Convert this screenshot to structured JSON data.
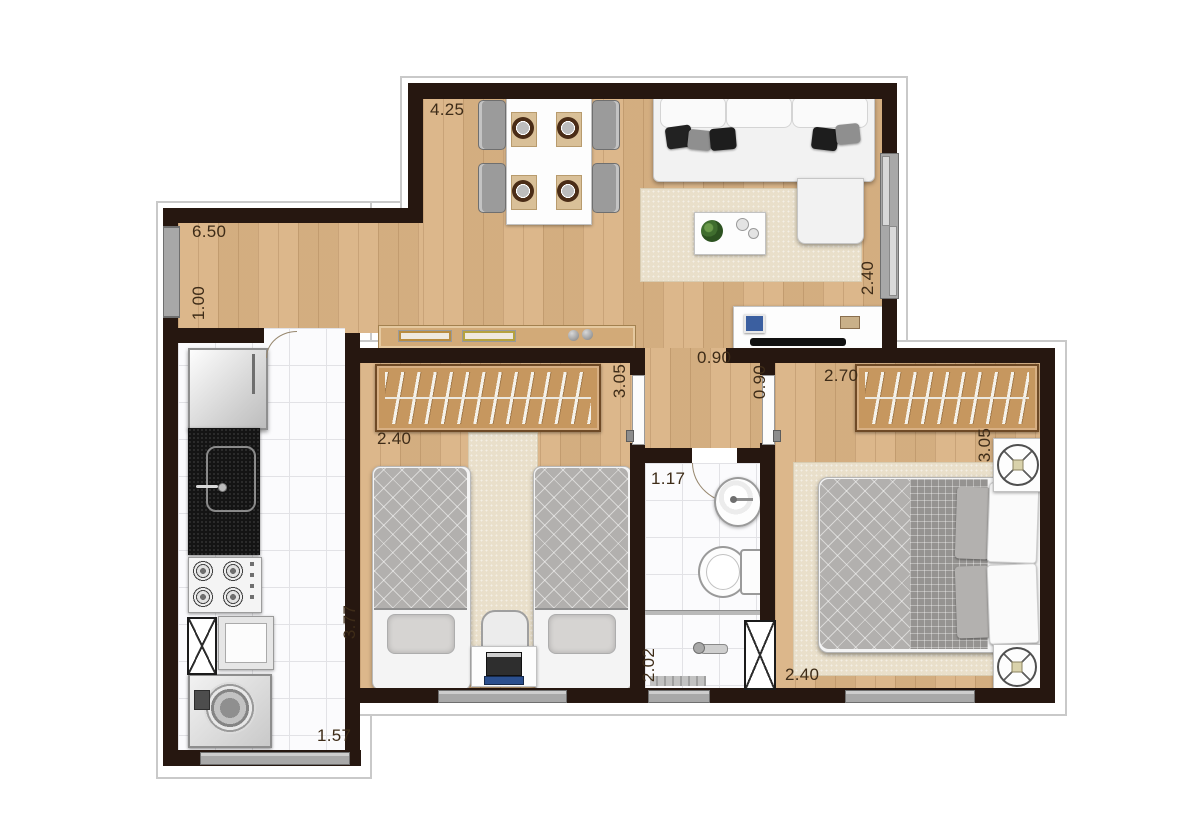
{
  "plan": {
    "type": "apartment-floor-plan",
    "colors": {
      "wall": "#261710",
      "wood_floor": "#dab384",
      "tile_floor": "#fbfbfd",
      "rug": "#e9dfca",
      "wardrobe_wood": "#c6975f",
      "label_text": "#3e2c18",
      "window_gray": "#a8a8a8",
      "outline_gray": "#c9c9c9"
    },
    "dimension_labels": [
      {
        "id": "dining-width",
        "value": "4.25",
        "orientation": "horizontal",
        "room": "living-dining"
      },
      {
        "id": "corridor-width",
        "value": "6.50",
        "orientation": "horizontal",
        "room": "entry-corridor"
      },
      {
        "id": "corridor-depth",
        "value": "1.00",
        "orientation": "vertical",
        "room": "entry-corridor"
      },
      {
        "id": "living-depth",
        "value": "2.40",
        "orientation": "vertical",
        "room": "living-dining"
      },
      {
        "id": "hall-opening-width",
        "value": "0.90",
        "orientation": "horizontal",
        "room": "hall"
      },
      {
        "id": "master-door-width",
        "value": "0.90",
        "orientation": "vertical",
        "room": "hall"
      },
      {
        "id": "master-width",
        "value": "2.70",
        "orientation": "horizontal",
        "room": "master-bedroom"
      },
      {
        "id": "bedroom2-depth",
        "value": "3.05",
        "orientation": "vertical",
        "room": "bedroom-2"
      },
      {
        "id": "bedroom2-width",
        "value": "2.40",
        "orientation": "horizontal",
        "room": "bedroom-2"
      },
      {
        "id": "master-depth",
        "value": "3.05",
        "orientation": "vertical",
        "room": "master-bedroom"
      },
      {
        "id": "bathroom-width",
        "value": "1.17",
        "orientation": "horizontal",
        "room": "bathroom"
      },
      {
        "id": "kitchen-depth",
        "value": "3.77",
        "orientation": "vertical",
        "room": "kitchen"
      },
      {
        "id": "shower-depth",
        "value": "2.02",
        "orientation": "vertical",
        "room": "bathroom"
      },
      {
        "id": "master-bottom-width",
        "value": "2.40",
        "orientation": "horizontal",
        "room": "master-bedroom"
      },
      {
        "id": "kitchen-width",
        "value": "1.57",
        "orientation": "horizontal",
        "room": "kitchen"
      }
    ],
    "rooms": [
      {
        "name": "living-dining",
        "furniture": [
          "dining-table",
          "dining-chairs",
          "sofa",
          "rug",
          "coffee-table",
          "plant",
          "tv-stand",
          "tv"
        ]
      },
      {
        "name": "entry-corridor",
        "furniture": [
          "entry-door",
          "sideboard"
        ]
      },
      {
        "name": "kitchen",
        "furniture": [
          "refrigerator",
          "counter-sink",
          "stove",
          "service-shaft",
          "laundry-tub",
          "washing-machine"
        ]
      },
      {
        "name": "bedroom-2",
        "furniture": [
          "wardrobe",
          "single-bed",
          "single-bed",
          "desk",
          "desk-chair",
          "rug"
        ]
      },
      {
        "name": "bathroom",
        "furniture": [
          "washbasin",
          "toilet",
          "shower",
          "service-shaft"
        ]
      },
      {
        "name": "master-bedroom",
        "furniture": [
          "wardrobe",
          "double-bed",
          "nightstand",
          "nightstand",
          "rug"
        ]
      }
    ]
  }
}
